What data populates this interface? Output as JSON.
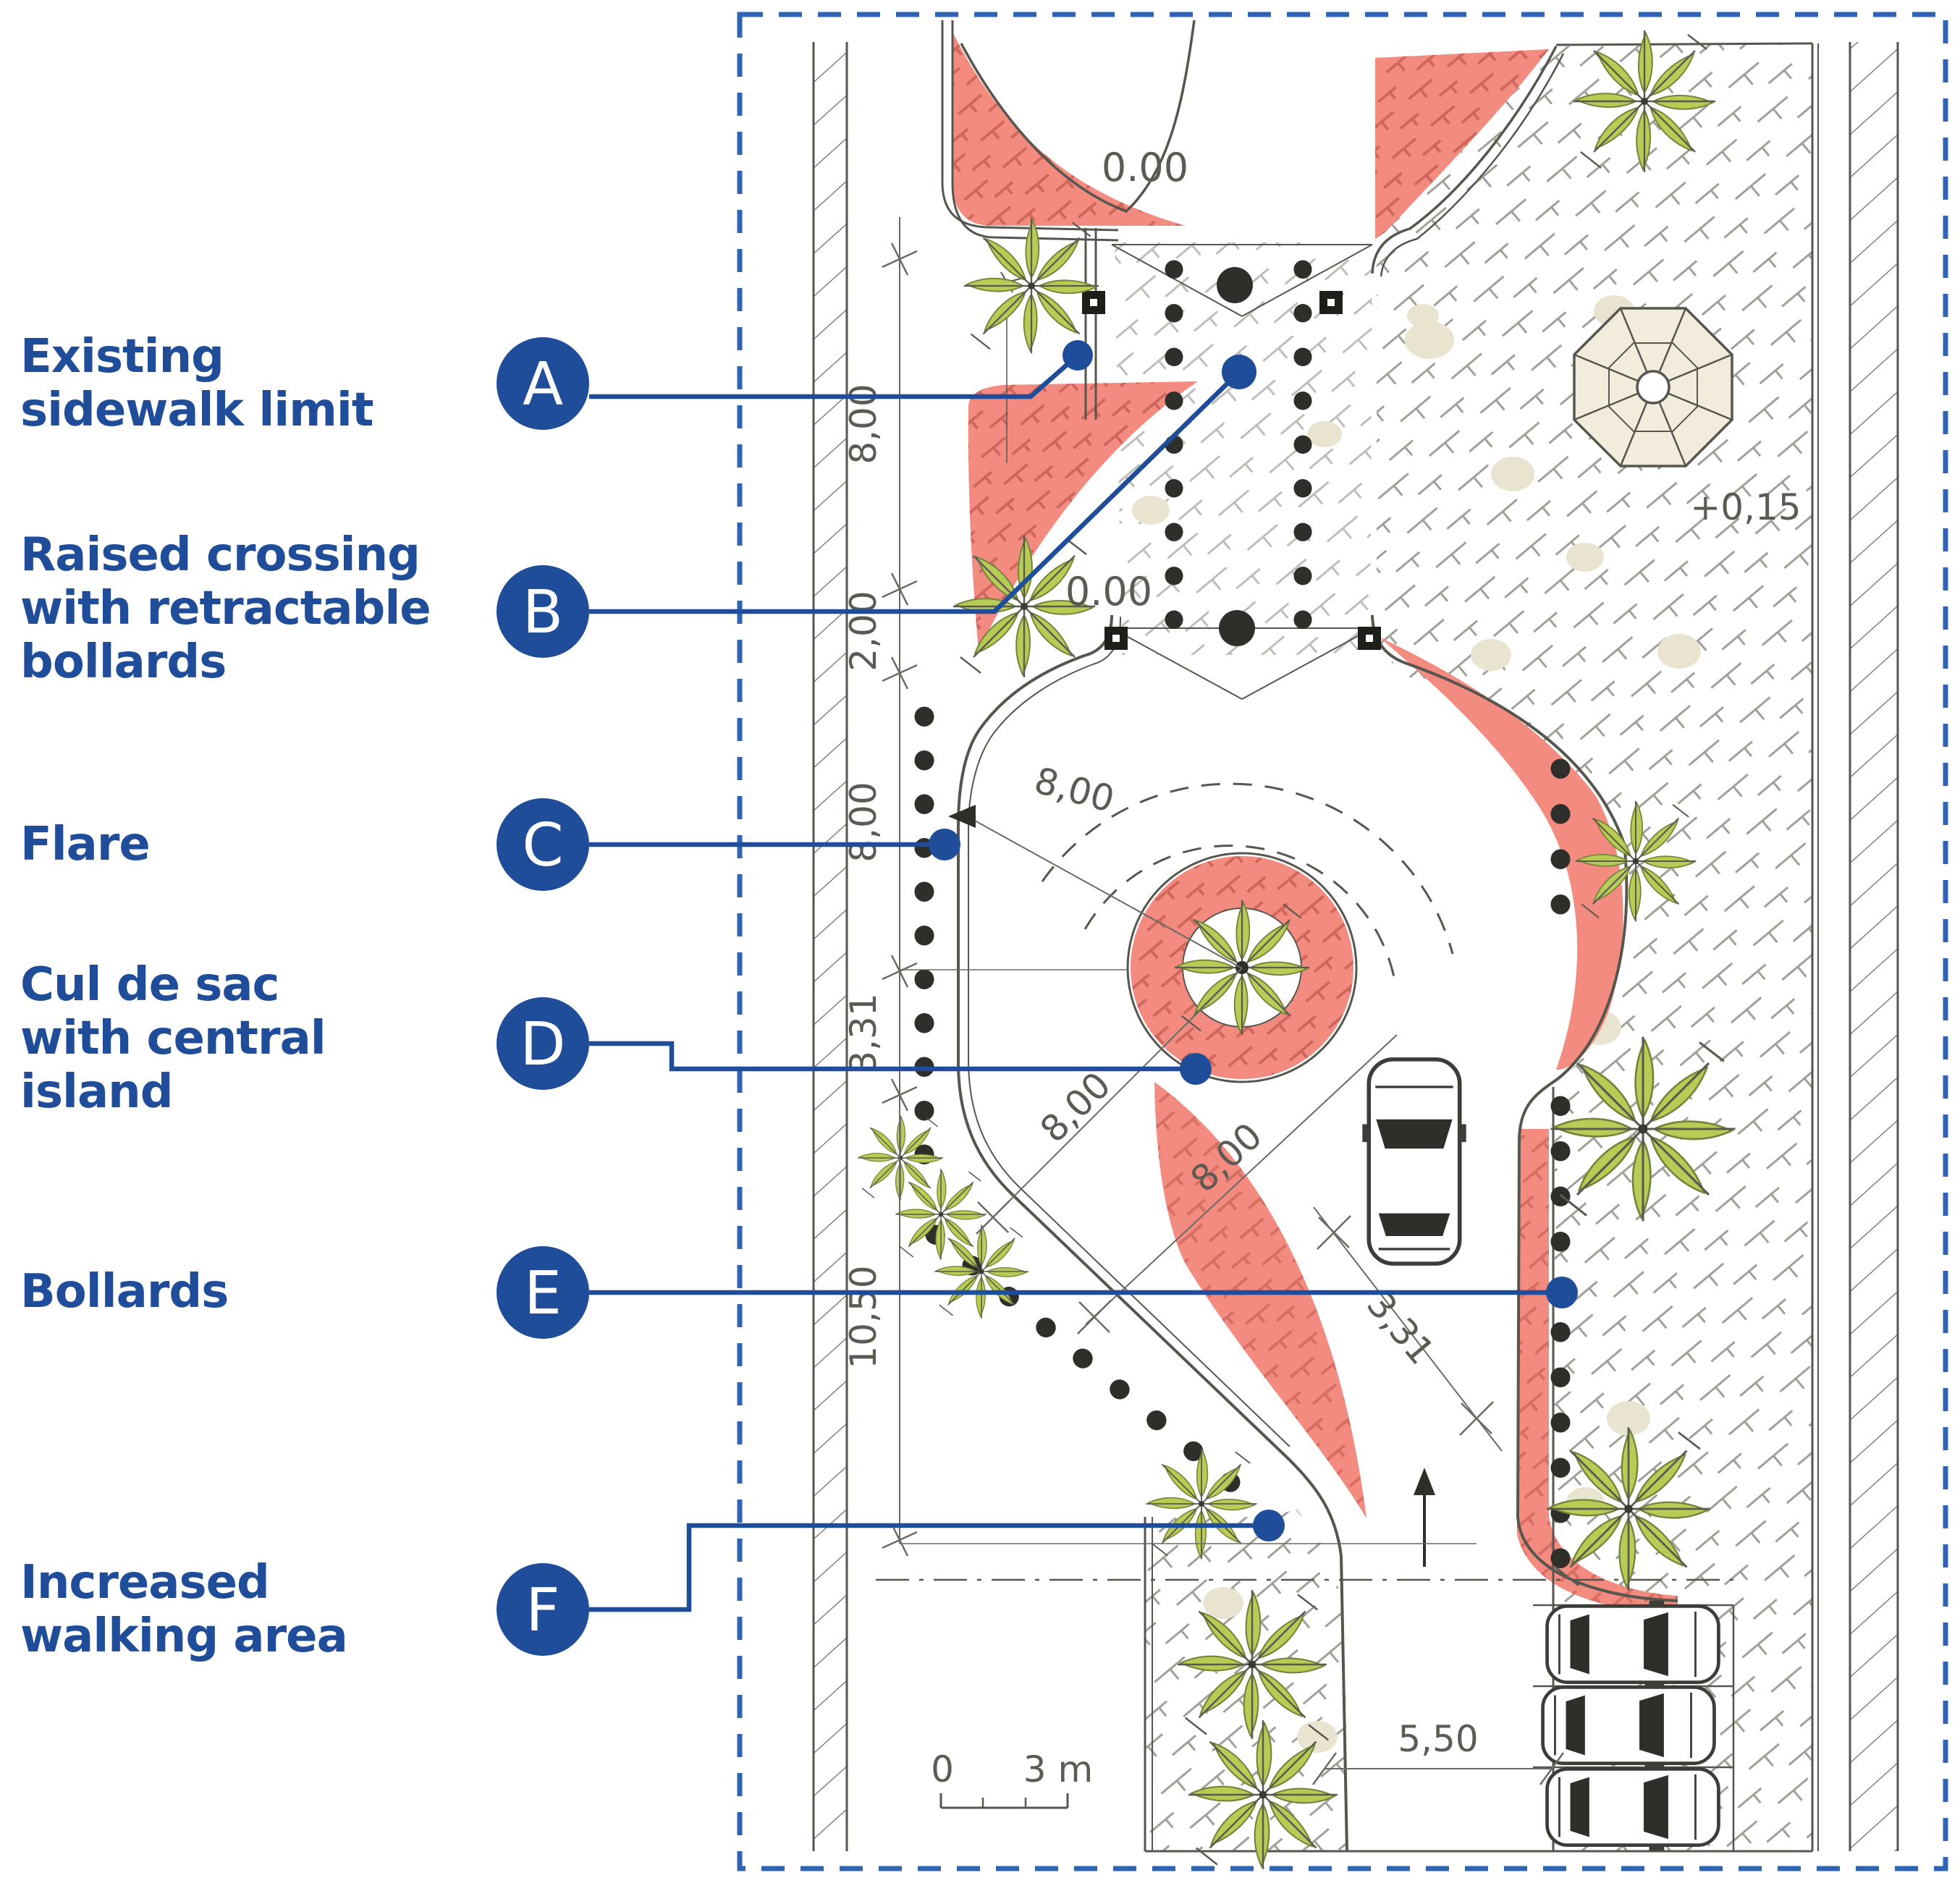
{
  "colors": {
    "accent_blue": "#1f4d9a",
    "frame_dash_blue": "#2f63b4",
    "flare_red": "#f48b80",
    "tree_green": "#b8cc55",
    "drawing_gray": "#56564e"
  },
  "annotations": [
    {
      "letter": "A",
      "label": "Existing sidewalk limit"
    },
    {
      "letter": "B",
      "label": "Raised crossing with retractable bollards"
    },
    {
      "letter": "C",
      "label": "Flare"
    },
    {
      "letter": "D",
      "label": "Cul de sac with central island"
    },
    {
      "letter": "E",
      "label": "Bollards"
    },
    {
      "letter": "F",
      "label": "Increased walking area"
    }
  ],
  "plan": {
    "levels": {
      "top_street": "0.00",
      "cul_de_sac": "0.00",
      "right_sidewalk": "+0,15"
    },
    "dims": {
      "left": [
        "8,00",
        "2,00",
        "8,00",
        "3,31",
        "10,50"
      ],
      "radius": "8,00",
      "diag_a": "8,00",
      "diag_b": "8,00",
      "lane": "3,31",
      "parking": "5,50"
    },
    "scalebar": {
      "zero": "0",
      "max": "3 m"
    }
  }
}
